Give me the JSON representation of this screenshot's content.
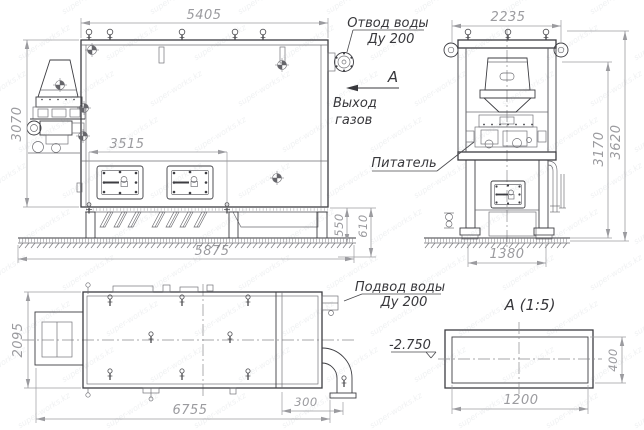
{
  "watermark": {
    "text": "super-works.kz"
  },
  "colors": {
    "background": "#ffffff",
    "line_main": "#3d3d42",
    "line_thin": "#6b6b70",
    "dimension": "#9b9b9f",
    "label": "#38383c"
  },
  "labels": {
    "view_arrow": "А",
    "water_outlet_1": "Отвод воды",
    "water_outlet_2": "Ду 200",
    "gas_exit_1": "Выход",
    "gas_exit_2": "газов",
    "feeder": "Питатель",
    "water_inlet_1": "Подвод воды",
    "water_inlet_2": "Ду 200",
    "section_title": "А  (1:5)",
    "elevation": "-2.750"
  },
  "dims": {
    "front": {
      "top_width": "5405",
      "height": "3070",
      "doors_span": "3515",
      "base_height": "550",
      "pit_depth": "610",
      "foundation_width": "5875"
    },
    "side": {
      "top_width": "2235",
      "inner_height": "3170",
      "total_height": "3620",
      "base_width": "1380"
    },
    "plan": {
      "depth": "2095",
      "total_length": "6755",
      "pipe_offset": "300"
    },
    "section": {
      "width": "1200",
      "height": "400"
    }
  }
}
